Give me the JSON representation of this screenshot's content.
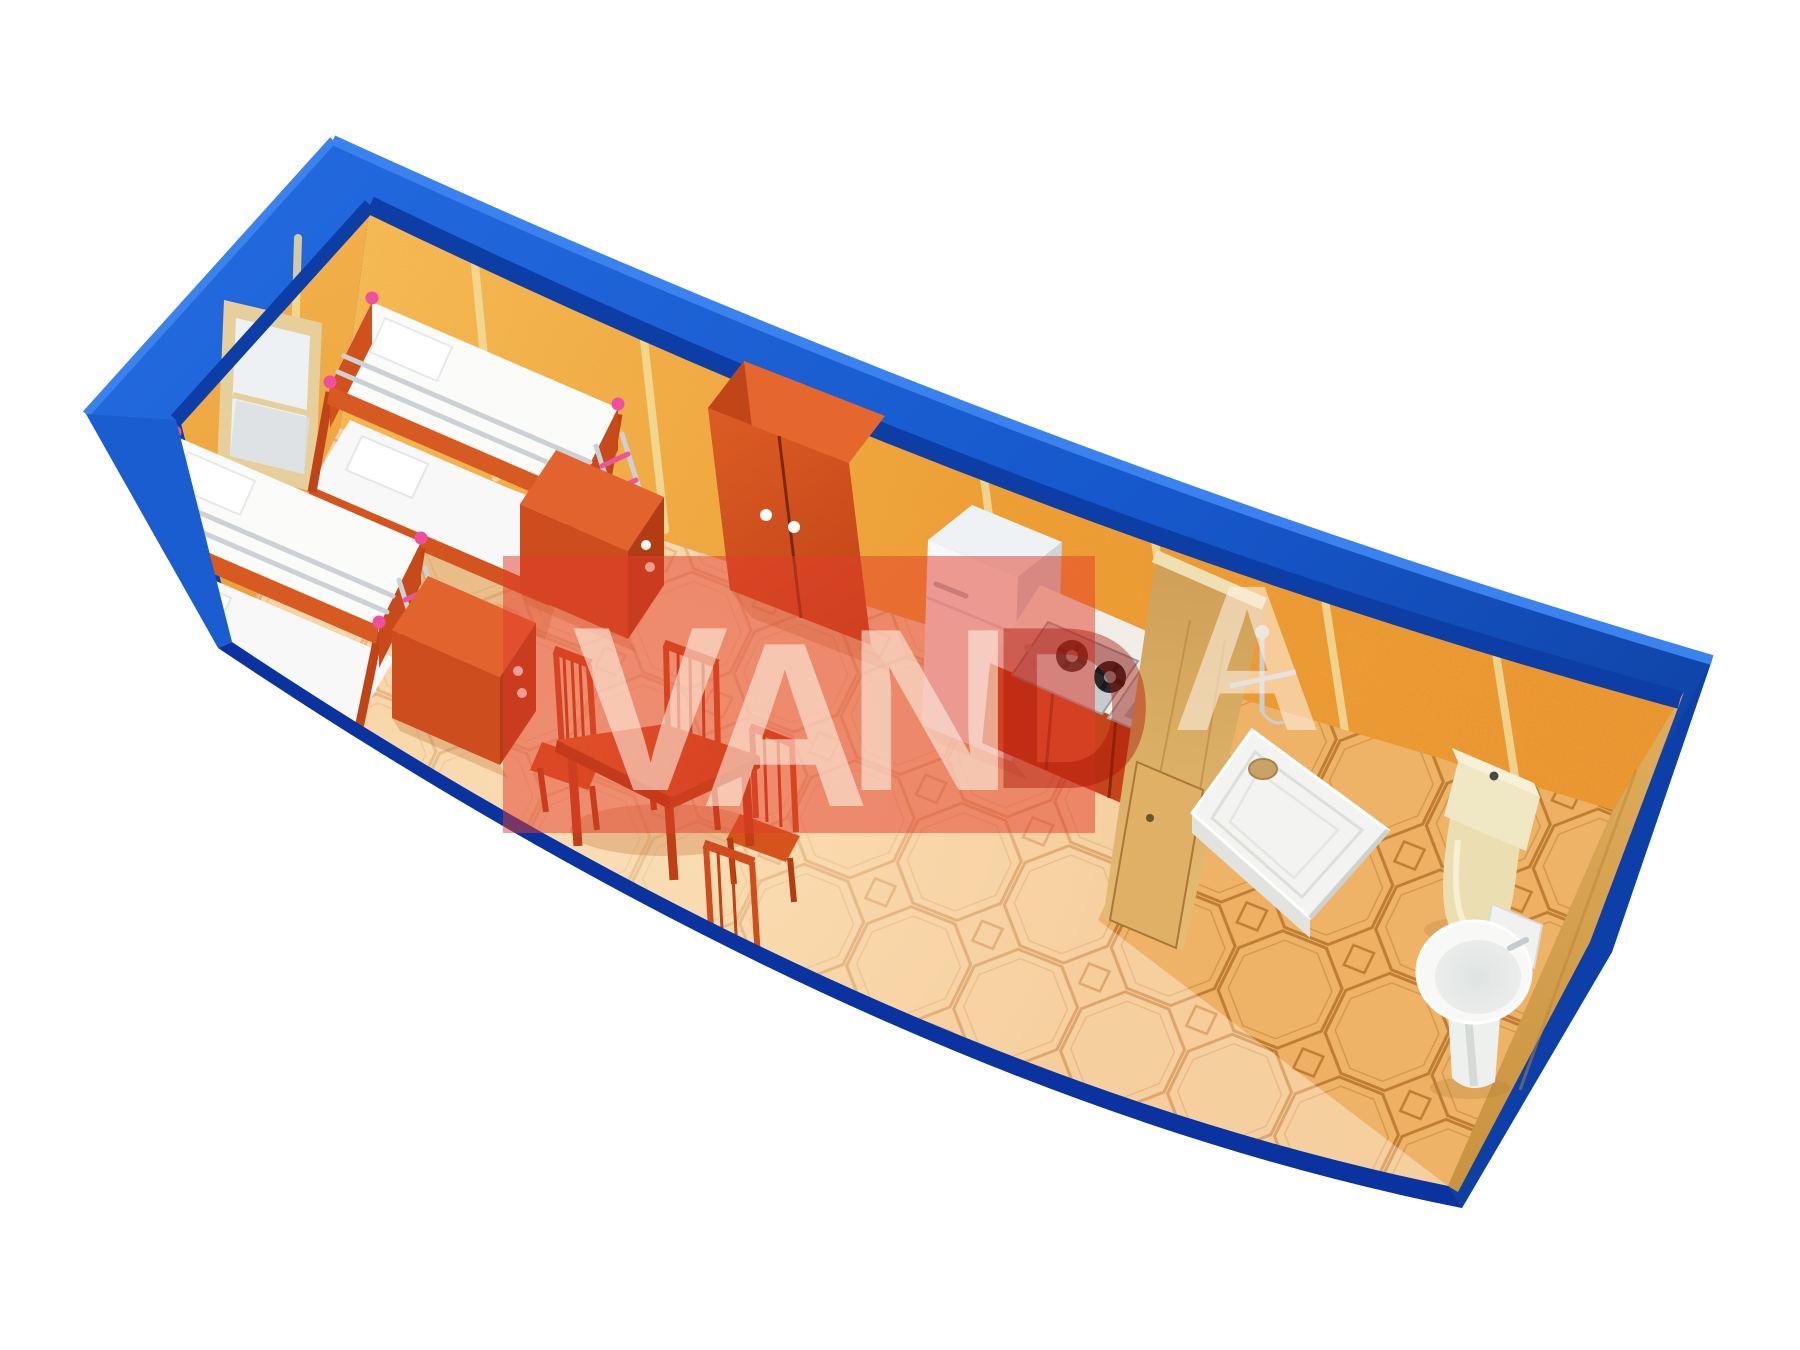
{
  "watermark": {
    "band_color": "#e23c2a",
    "letters": [
      {
        "char": "V",
        "color": "#fdf2e4"
      },
      {
        "char": "A",
        "color": "#fdf2e4"
      },
      {
        "char": "N",
        "color": "#fdf2e4"
      },
      {
        "char": "D",
        "color": "#a81004"
      },
      {
        "char": "A",
        "color": "#fdf2e4"
      }
    ]
  },
  "palette": {
    "container_blue": "#1a5fd4",
    "container_blue_dark": "#0d3fa8",
    "container_navy": "#0a33a0",
    "wall_orange": "#f0a03c",
    "wall_seam": "#f2dc9c",
    "floor_main": "#f6cd9b",
    "floor_bath": "#eeb062",
    "furniture_red": "#d4541f",
    "wood_tan": "#d9a757",
    "mattress_white": "#fafafa",
    "accent_pink": "#ee4f9e",
    "fixture_white": "#f3f4f1",
    "toilet_cream": "#efe6c2"
  },
  "objects": [
    "container-cabin",
    "window",
    "bunk-bed",
    "bunk-bed",
    "nightstand",
    "nightstand",
    "wardrobe",
    "dining-table",
    "chair",
    "chair",
    "chair",
    "chair",
    "refrigerator",
    "gas-cooktop",
    "kitchen-sink",
    "wood-partition-door",
    "shower-tray",
    "shower-mixer",
    "toilet",
    "pedestal-basin"
  ]
}
